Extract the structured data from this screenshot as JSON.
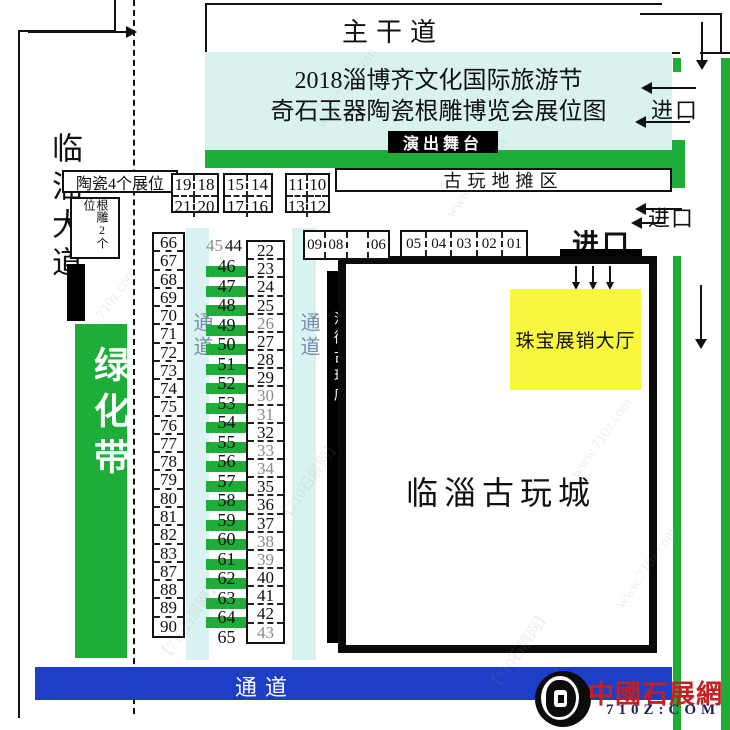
{
  "map": {
    "title_line1": "2018淄博齐文化国际旅游节",
    "title_line2": "奇石玉器陶瓷根雕博览会展位图",
    "top_road": "主干道",
    "left_road": "临淄大道",
    "stage": "演出舞台",
    "stall_area": "古玩地摊区",
    "ceramic_label": "陶瓷4个展位",
    "root_label": "根雕2个位",
    "green_belt": "绿化带",
    "aisle": "通道",
    "street_shops": "沿街古玩店",
    "jewelry_hall": "珠宝展销大厅",
    "antique_city": "临淄古玩城",
    "entrance": "进口"
  },
  "booths": {
    "top_boxes": [
      {
        "cells": [
          "19",
          "18",
          "21",
          "20"
        ]
      },
      {
        "cells": [
          "15",
          "14",
          "17",
          "16"
        ]
      },
      {
        "cells": [
          "11",
          "10",
          "13",
          "12"
        ]
      }
    ],
    "shop_row_a": [
      "09",
      "08",
      "",
      "06"
    ],
    "shop_row_b": [
      "05",
      "04",
      "03",
      "02",
      "01"
    ],
    "left_column": [
      "66",
      "67",
      "68",
      "69",
      "70",
      "71",
      "72",
      "73",
      "74",
      "75",
      "76",
      "77",
      "78",
      "79",
      "80",
      "81",
      "82",
      "83",
      "87",
      "88",
      "89",
      "90"
    ],
    "middle_top": [
      "45",
      "44"
    ],
    "middle_column": [
      "46",
      "47",
      "48",
      "49",
      "50",
      "51",
      "52",
      "53",
      "54",
      "55",
      "56",
      "57",
      "58",
      "59",
      "60",
      "61",
      "62",
      "63",
      "64",
      "65"
    ],
    "right_column": [
      "22",
      "23",
      "24",
      "25",
      "26",
      "27",
      "28",
      "29",
      "30",
      "31",
      "32",
      "33",
      "34",
      "35",
      "36",
      "37",
      "38",
      "39",
      "40",
      "41",
      "42",
      "43"
    ],
    "gray_numbers": [
      "45",
      "26",
      "30",
      "31",
      "33",
      "34",
      "38",
      "39",
      "43"
    ]
  },
  "logo": {
    "site_name": "中國石展網",
    "site_url": "710Z:COM"
  },
  "watermarks": [
    "www.710z.com",
    "【710石展网】"
  ],
  "colors": {
    "green": "#1ead38",
    "cyan_title": "#d9f2ee",
    "cyan_aisle": "#d8f3f2",
    "blue": "#1d3fc8",
    "yellow": "#f8f73d",
    "red": "#c42020",
    "aisle_text": "#7b8cab"
  }
}
